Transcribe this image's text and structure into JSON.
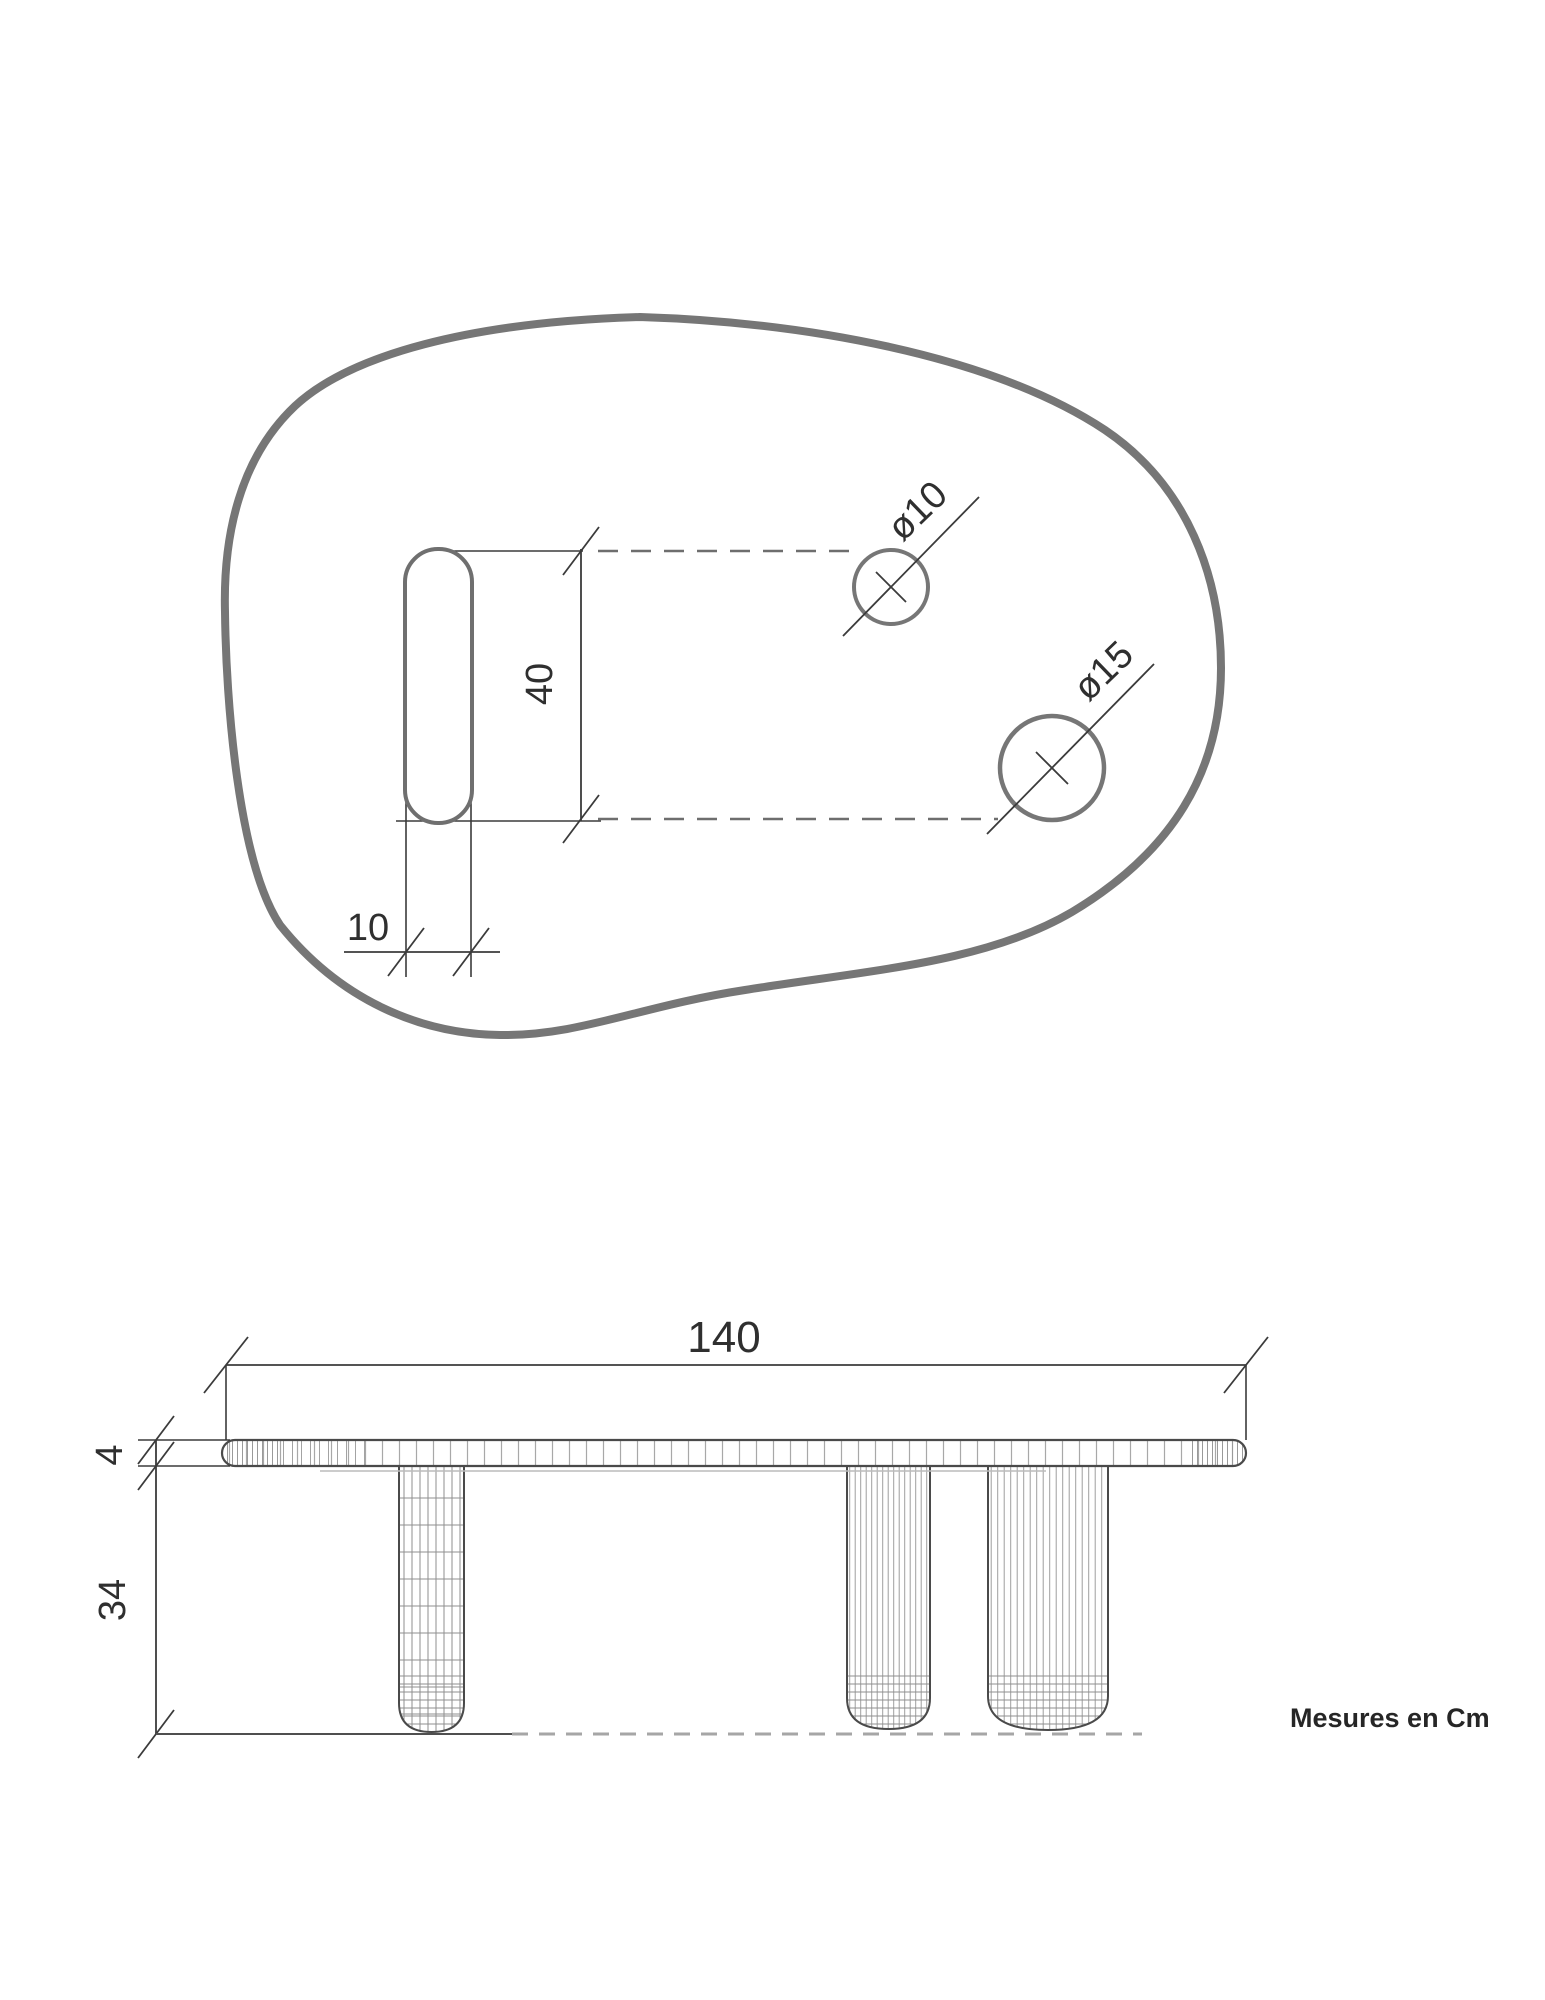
{
  "title": "Table technical drawing",
  "units_note": "Mesures en Cm",
  "top_view": {
    "slot_length_label": "40",
    "slot_width_label": "10",
    "hole_small_label": "ø10",
    "hole_large_label": "ø15"
  },
  "side_view": {
    "width_label": "140",
    "top_thickness_label": "4",
    "leg_height_label": "34"
  },
  "colors": {
    "outline_gray": "#767676",
    "dimension_line": "#3b3b3b",
    "text": "#2f2f2f",
    "hatch": "#9a9a9a",
    "ground_dash": "#a6a6a6"
  }
}
